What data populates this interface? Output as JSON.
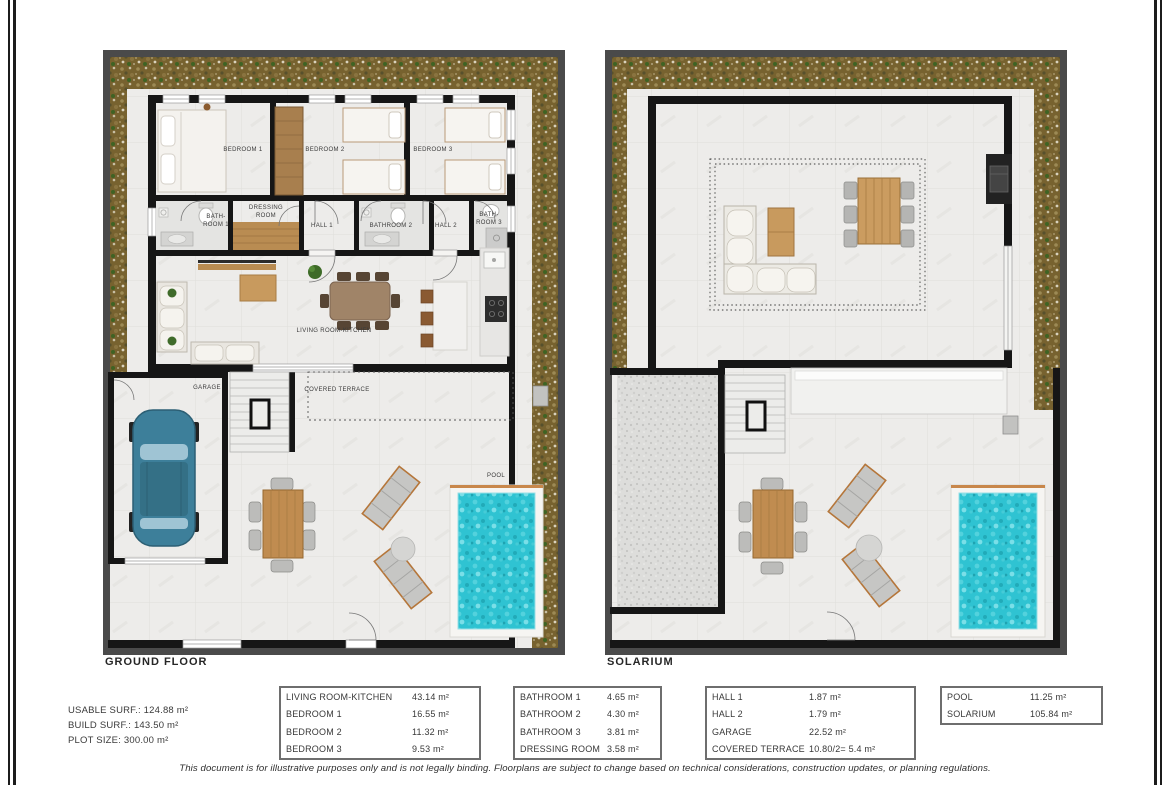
{
  "plans": {
    "ground": {
      "title": "GROUND FLOOR",
      "labels": {
        "bedroom1": "BEDROOM 1",
        "bedroom2": "BEDROOM 2",
        "bedroom3": "BEDROOM 3",
        "bathroom1": "BATH-\nROOM 1",
        "dressing": "DRESSING\nROOM",
        "hall1": "HALL 1",
        "bathroom2": "BATHROOM 2",
        "hall2": "HALL 2",
        "bathroom3": "BATH-\nROOM 3",
        "living": "LIVING ROOM-KITCHEN",
        "garage": "GARAGE",
        "terrace": "COVERED TERRACE",
        "pool": "POOL"
      }
    },
    "solarium": {
      "title": "SOLARIUM"
    }
  },
  "stats": {
    "line1": "USABLE SURF.: 124.88 m²",
    "line2": "BUILD SURF.: 143.50 m²",
    "line3": "PLOT SIZE: 300.00 m²"
  },
  "tables": [
    {
      "rows": [
        {
          "label": "LIVING ROOM-KITCHEN",
          "value": "43.14 m²"
        },
        {
          "label": "BEDROOM 1",
          "value": "16.55 m²"
        },
        {
          "label": "BEDROOM 2",
          "value": "11.32 m²"
        },
        {
          "label": "BEDROOM 3",
          "value": "9.53 m²"
        }
      ]
    },
    {
      "rows": [
        {
          "label": "BATHROOM 1",
          "value": "4.65 m²"
        },
        {
          "label": "BATHROOM 2",
          "value": "4.30 m²"
        },
        {
          "label": "BATHROOM 3",
          "value": "3.81 m²"
        },
        {
          "label": "DRESSING ROOM",
          "value": "3.58 m²"
        }
      ]
    },
    {
      "rows": [
        {
          "label": "HALL 1",
          "value": "1.87 m²"
        },
        {
          "label": "HALL 2",
          "value": "1.79 m²"
        },
        {
          "label": "GARAGE",
          "value": "22.52 m²"
        },
        {
          "label": "COVERED TERRACE",
          "value": "10.80/2= 5.4 m²"
        }
      ]
    },
    {
      "rows": [
        {
          "label": "POOL",
          "value": "11.25 m²"
        },
        {
          "label": "SOLARIUM",
          "value": "105.84 m²"
        }
      ]
    }
  ],
  "disclaimer": "This document is for illustrative purposes only and is not legally binding. Floorplans are subject to change based on technical considerations, construction updates, or planning regulations.",
  "colors": {
    "pool_water": "#2fc3d2",
    "garden": "#77622f",
    "wall": "#161616",
    "site_border": "#4a4a4a",
    "wood": "#bd9059",
    "lounger_frame": "#b5763a"
  }
}
